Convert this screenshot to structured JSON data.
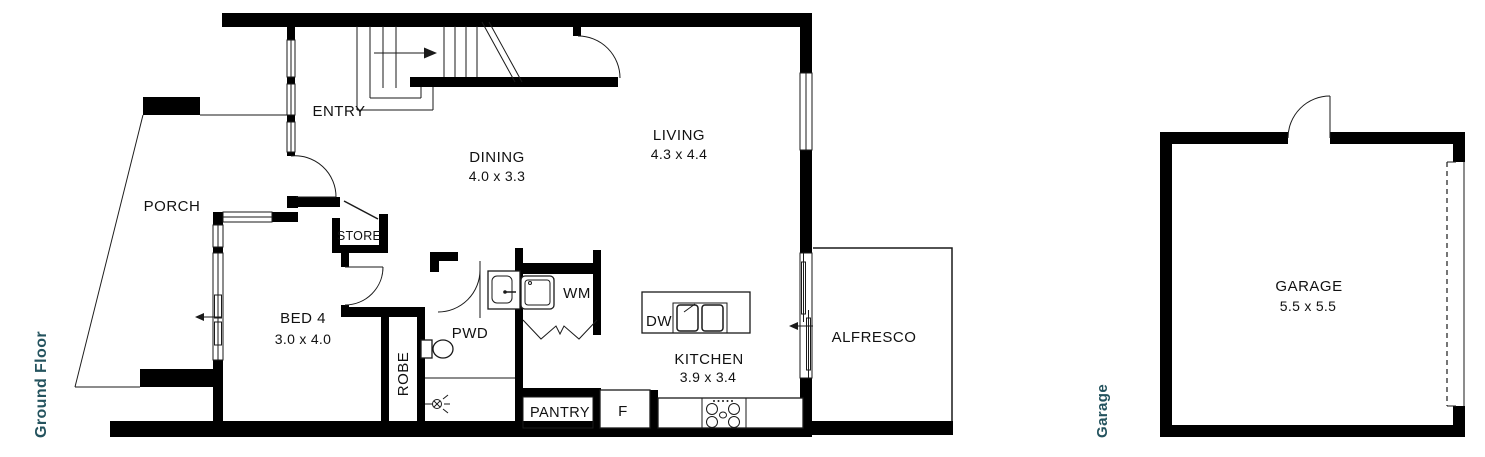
{
  "colors": {
    "background": "#ffffff",
    "wall": "#000000",
    "line": "#1a1a1a",
    "ink": "#111111",
    "accent": "#24535e"
  },
  "side_labels": {
    "ground_floor": "Ground Floor",
    "garage": "Garage"
  },
  "rooms": {
    "porch": {
      "name": "PORCH"
    },
    "entry": {
      "name": "ENTRY"
    },
    "dining": {
      "name": "DINING",
      "dims": "4.0 x 3.3"
    },
    "living": {
      "name": "LIVING",
      "dims": "4.3 x 4.4"
    },
    "bed4": {
      "name": "BED 4",
      "dims": "3.0 x 4.0"
    },
    "store": {
      "name": "STORE"
    },
    "pwd": {
      "name": "PWD"
    },
    "robe": {
      "name": "ROBE"
    },
    "laundry": {
      "name": "WM"
    },
    "island": {
      "name": "DW"
    },
    "kitchen": {
      "name": "KITCHEN",
      "dims": "3.9 x 3.4"
    },
    "pantry": {
      "name": "PANTRY"
    },
    "fridge": {
      "name": "F"
    },
    "alfresco": {
      "name": "ALFRESCO"
    },
    "garage": {
      "name": "GARAGE",
      "dims": "5.5 x 5.5"
    }
  }
}
